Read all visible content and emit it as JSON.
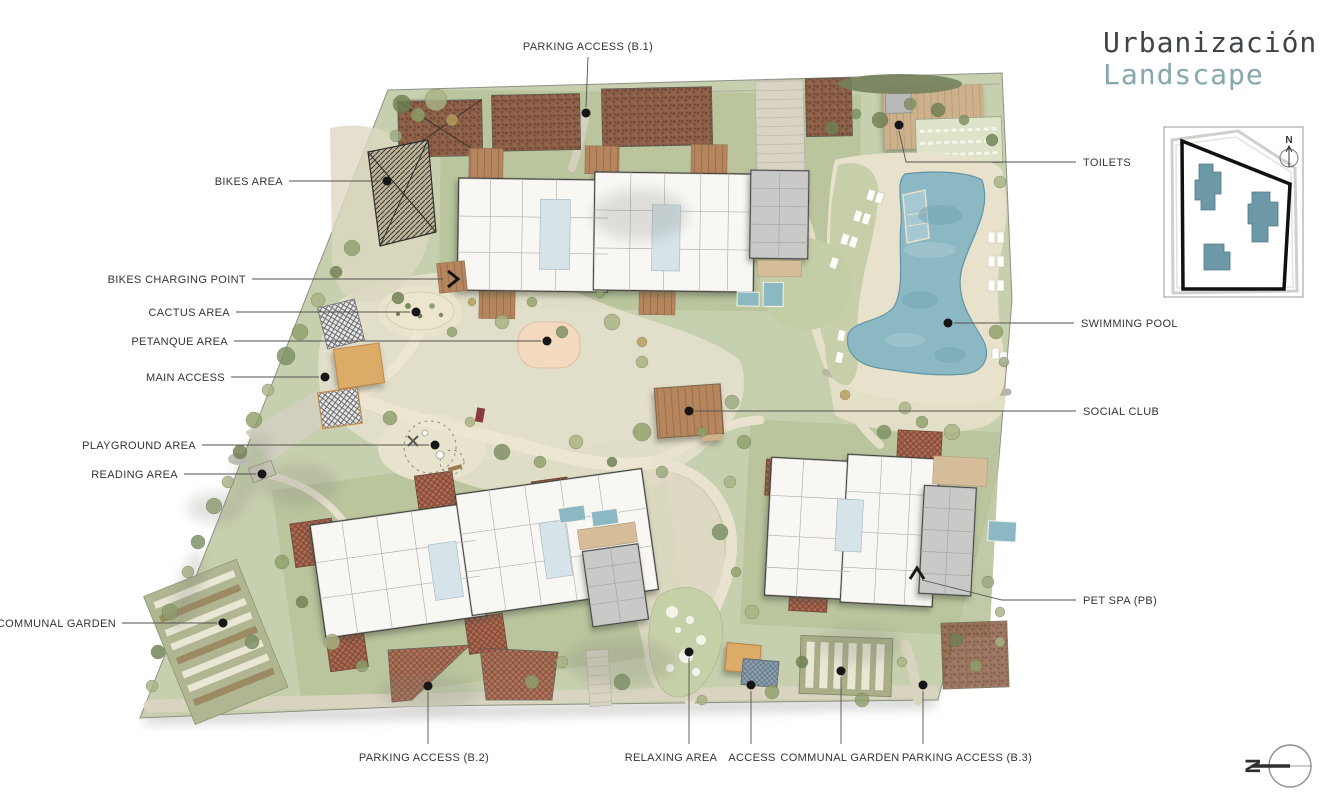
{
  "title": {
    "main": "Urbanización",
    "sub": "Landscape"
  },
  "plan_labels": {
    "parking_b1": "PARKING ACCESS (B.1)",
    "bikes_area": "BIKES AREA",
    "bikes_charging": "BIKES CHARGING POINT",
    "cactus": "CACTUS AREA",
    "petanque": "PETANQUE AREA",
    "main_access": "MAIN ACCESS",
    "playground": "PLAYGROUND AREA",
    "reading": "READING AREA",
    "communal_left": "COMMUNAL GARDEN",
    "parking_b2": "PARKING ACCESS (B.2)",
    "relaxing": "RELAXING AREA",
    "access": "ACCESS",
    "communal_bottom": "COMMUNAL GARDEN",
    "parking_b3": "PARKING ACCESS (B.3)",
    "toilets": "TOILETS",
    "swimming_pool": "SWIMMING POOL",
    "social_club": "SOCIAL CLUB",
    "pet_spa": "PET SPA (PB)"
  },
  "keyplan": {
    "north": "N"
  },
  "compass": {
    "north": "N"
  },
  "colors": {
    "title_ink": "#3f4449",
    "title_accent": "#85a8ac",
    "label_ink": "#343434",
    "lawn": "#c7d0ae",
    "pool_water": "#8cb8c4",
    "pergola_terracotta": "#ad6a52",
    "roof_gray": "#c9c9c7",
    "keyplan_building_teal": "#6d98a5"
  }
}
